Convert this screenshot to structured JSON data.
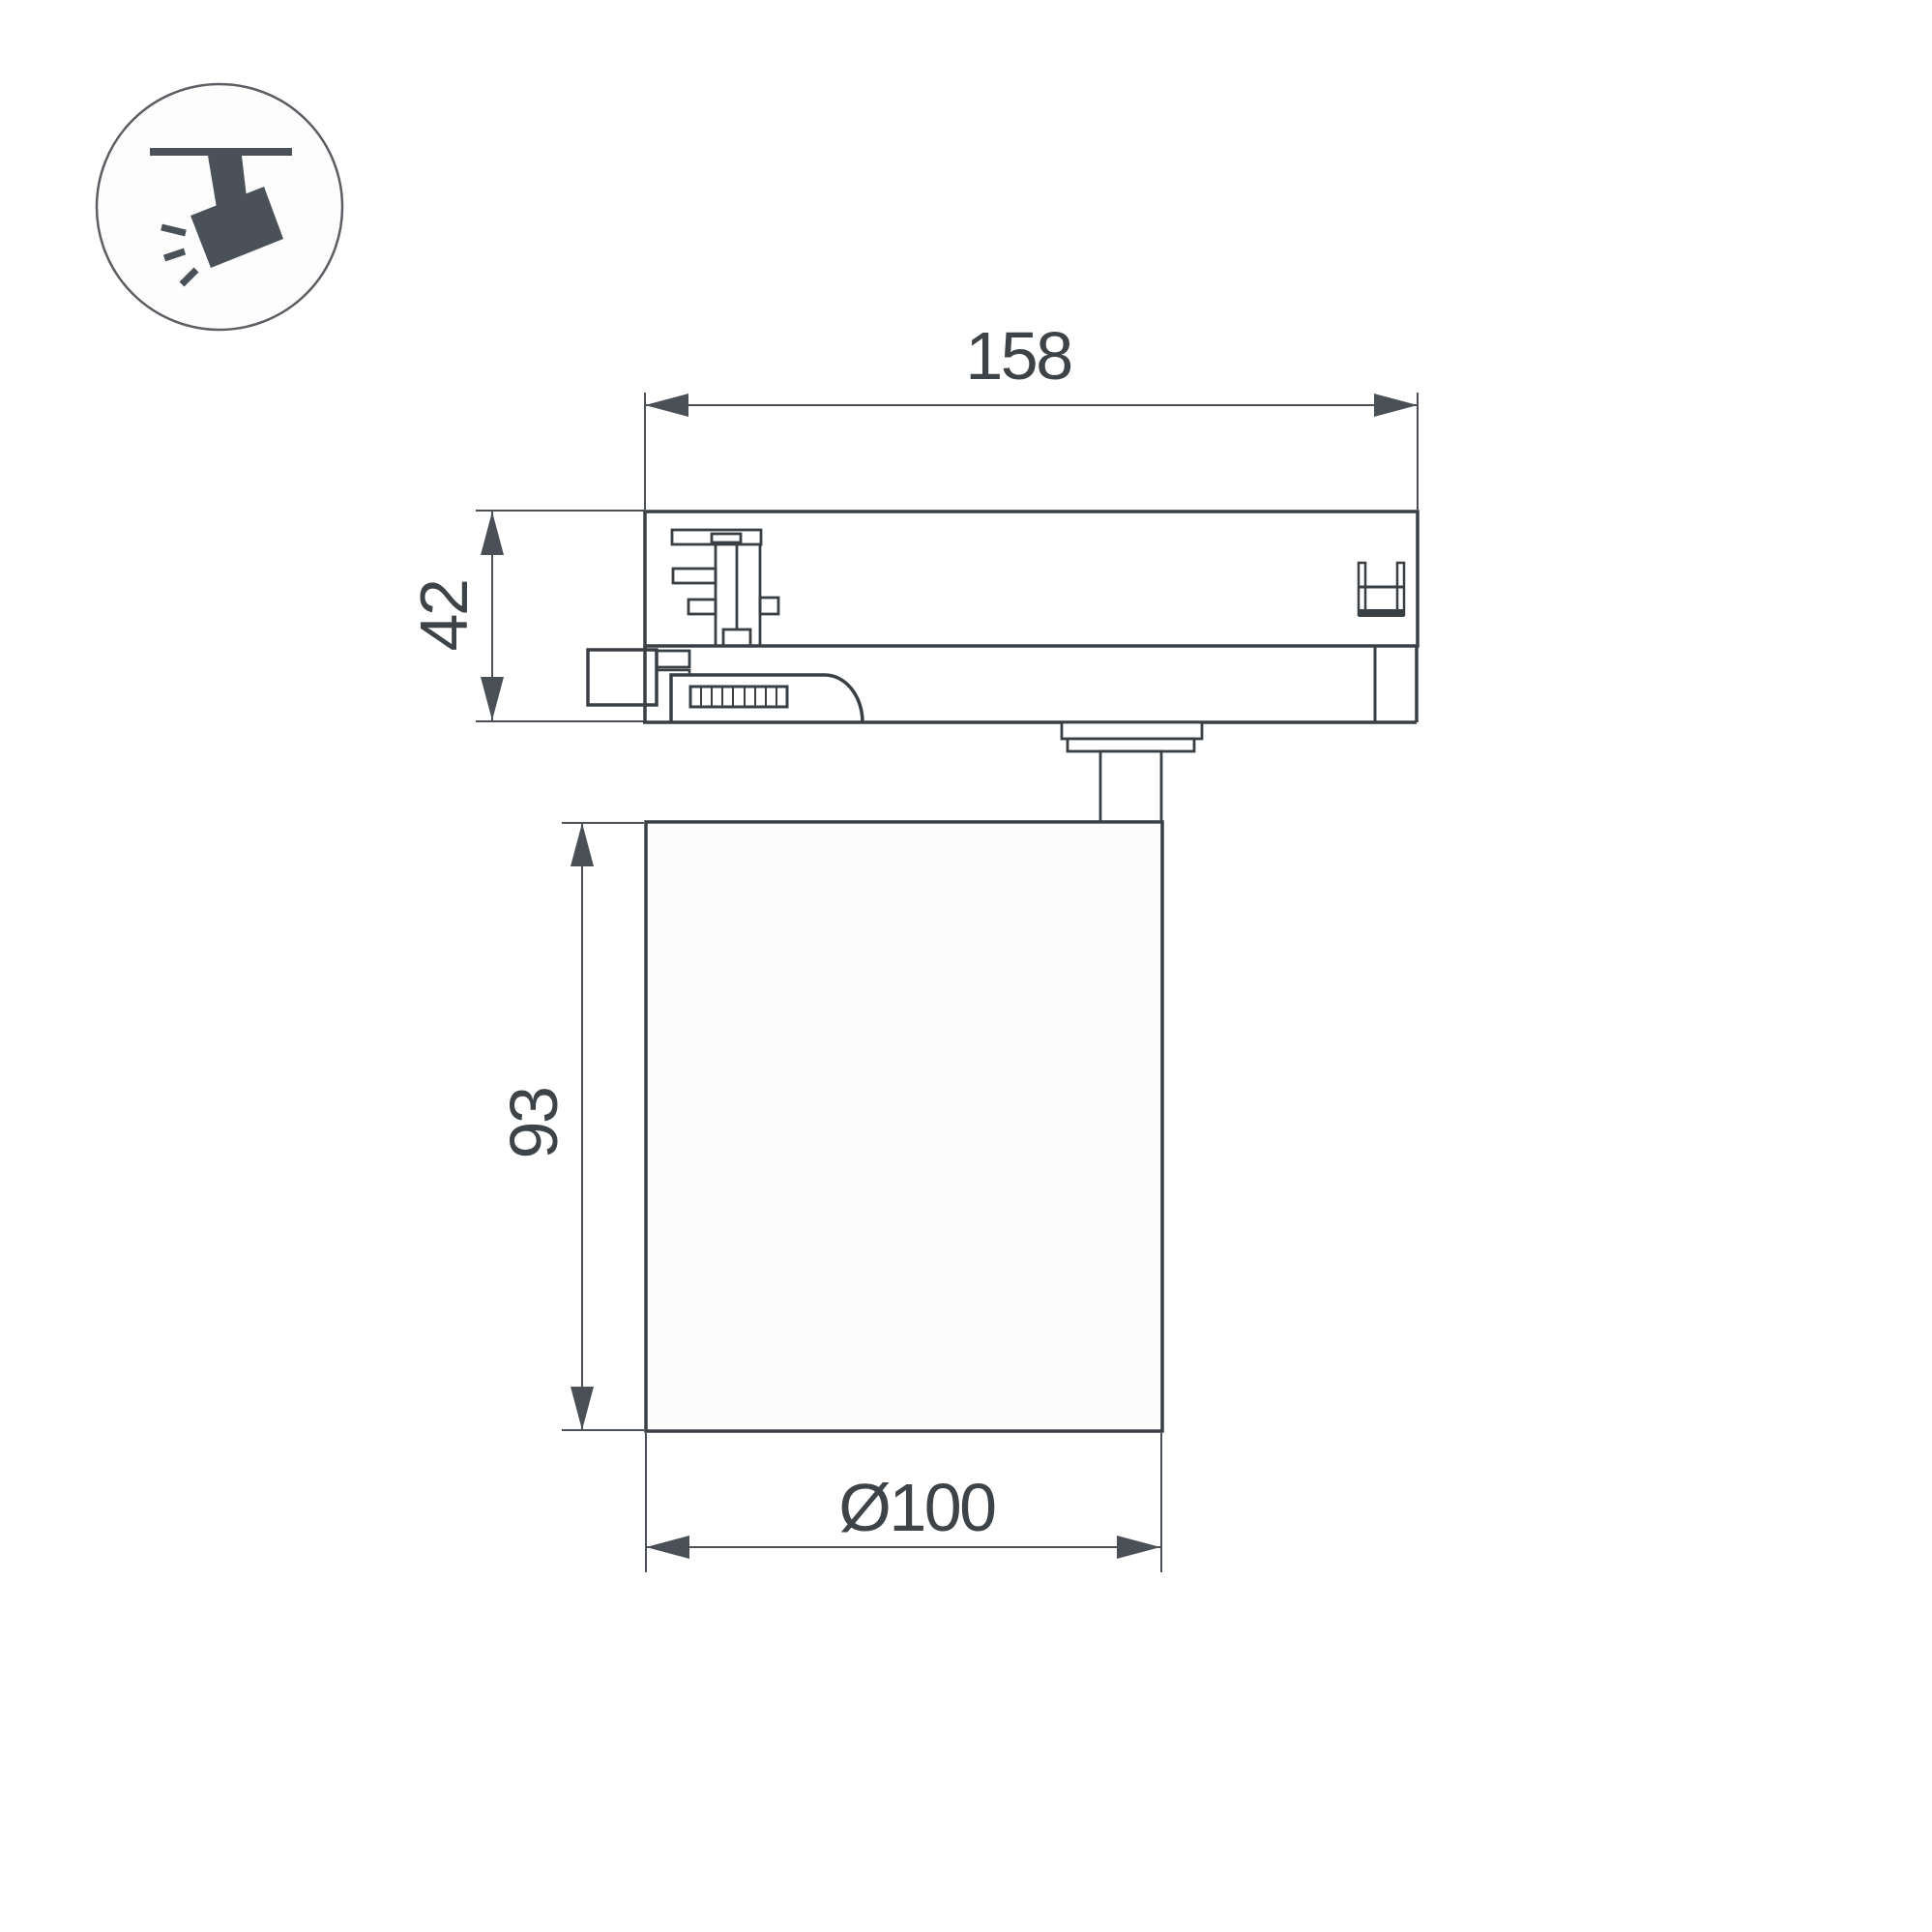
{
  "icon": {
    "name": "track-spotlight-icon"
  },
  "dimension_labels": {
    "overall_length": "158",
    "adapter_height": "42",
    "body_height": "93",
    "body_diameter": "Ø100"
  },
  "colors": {
    "background": "#ffffff",
    "outline": "#3a3f44",
    "dimension": "#4b5056",
    "label_text": "#3e4348",
    "icon_fill": "#4a5158",
    "fill_white": "#ffffff",
    "lamp_fill": "#fcfcfc"
  }
}
